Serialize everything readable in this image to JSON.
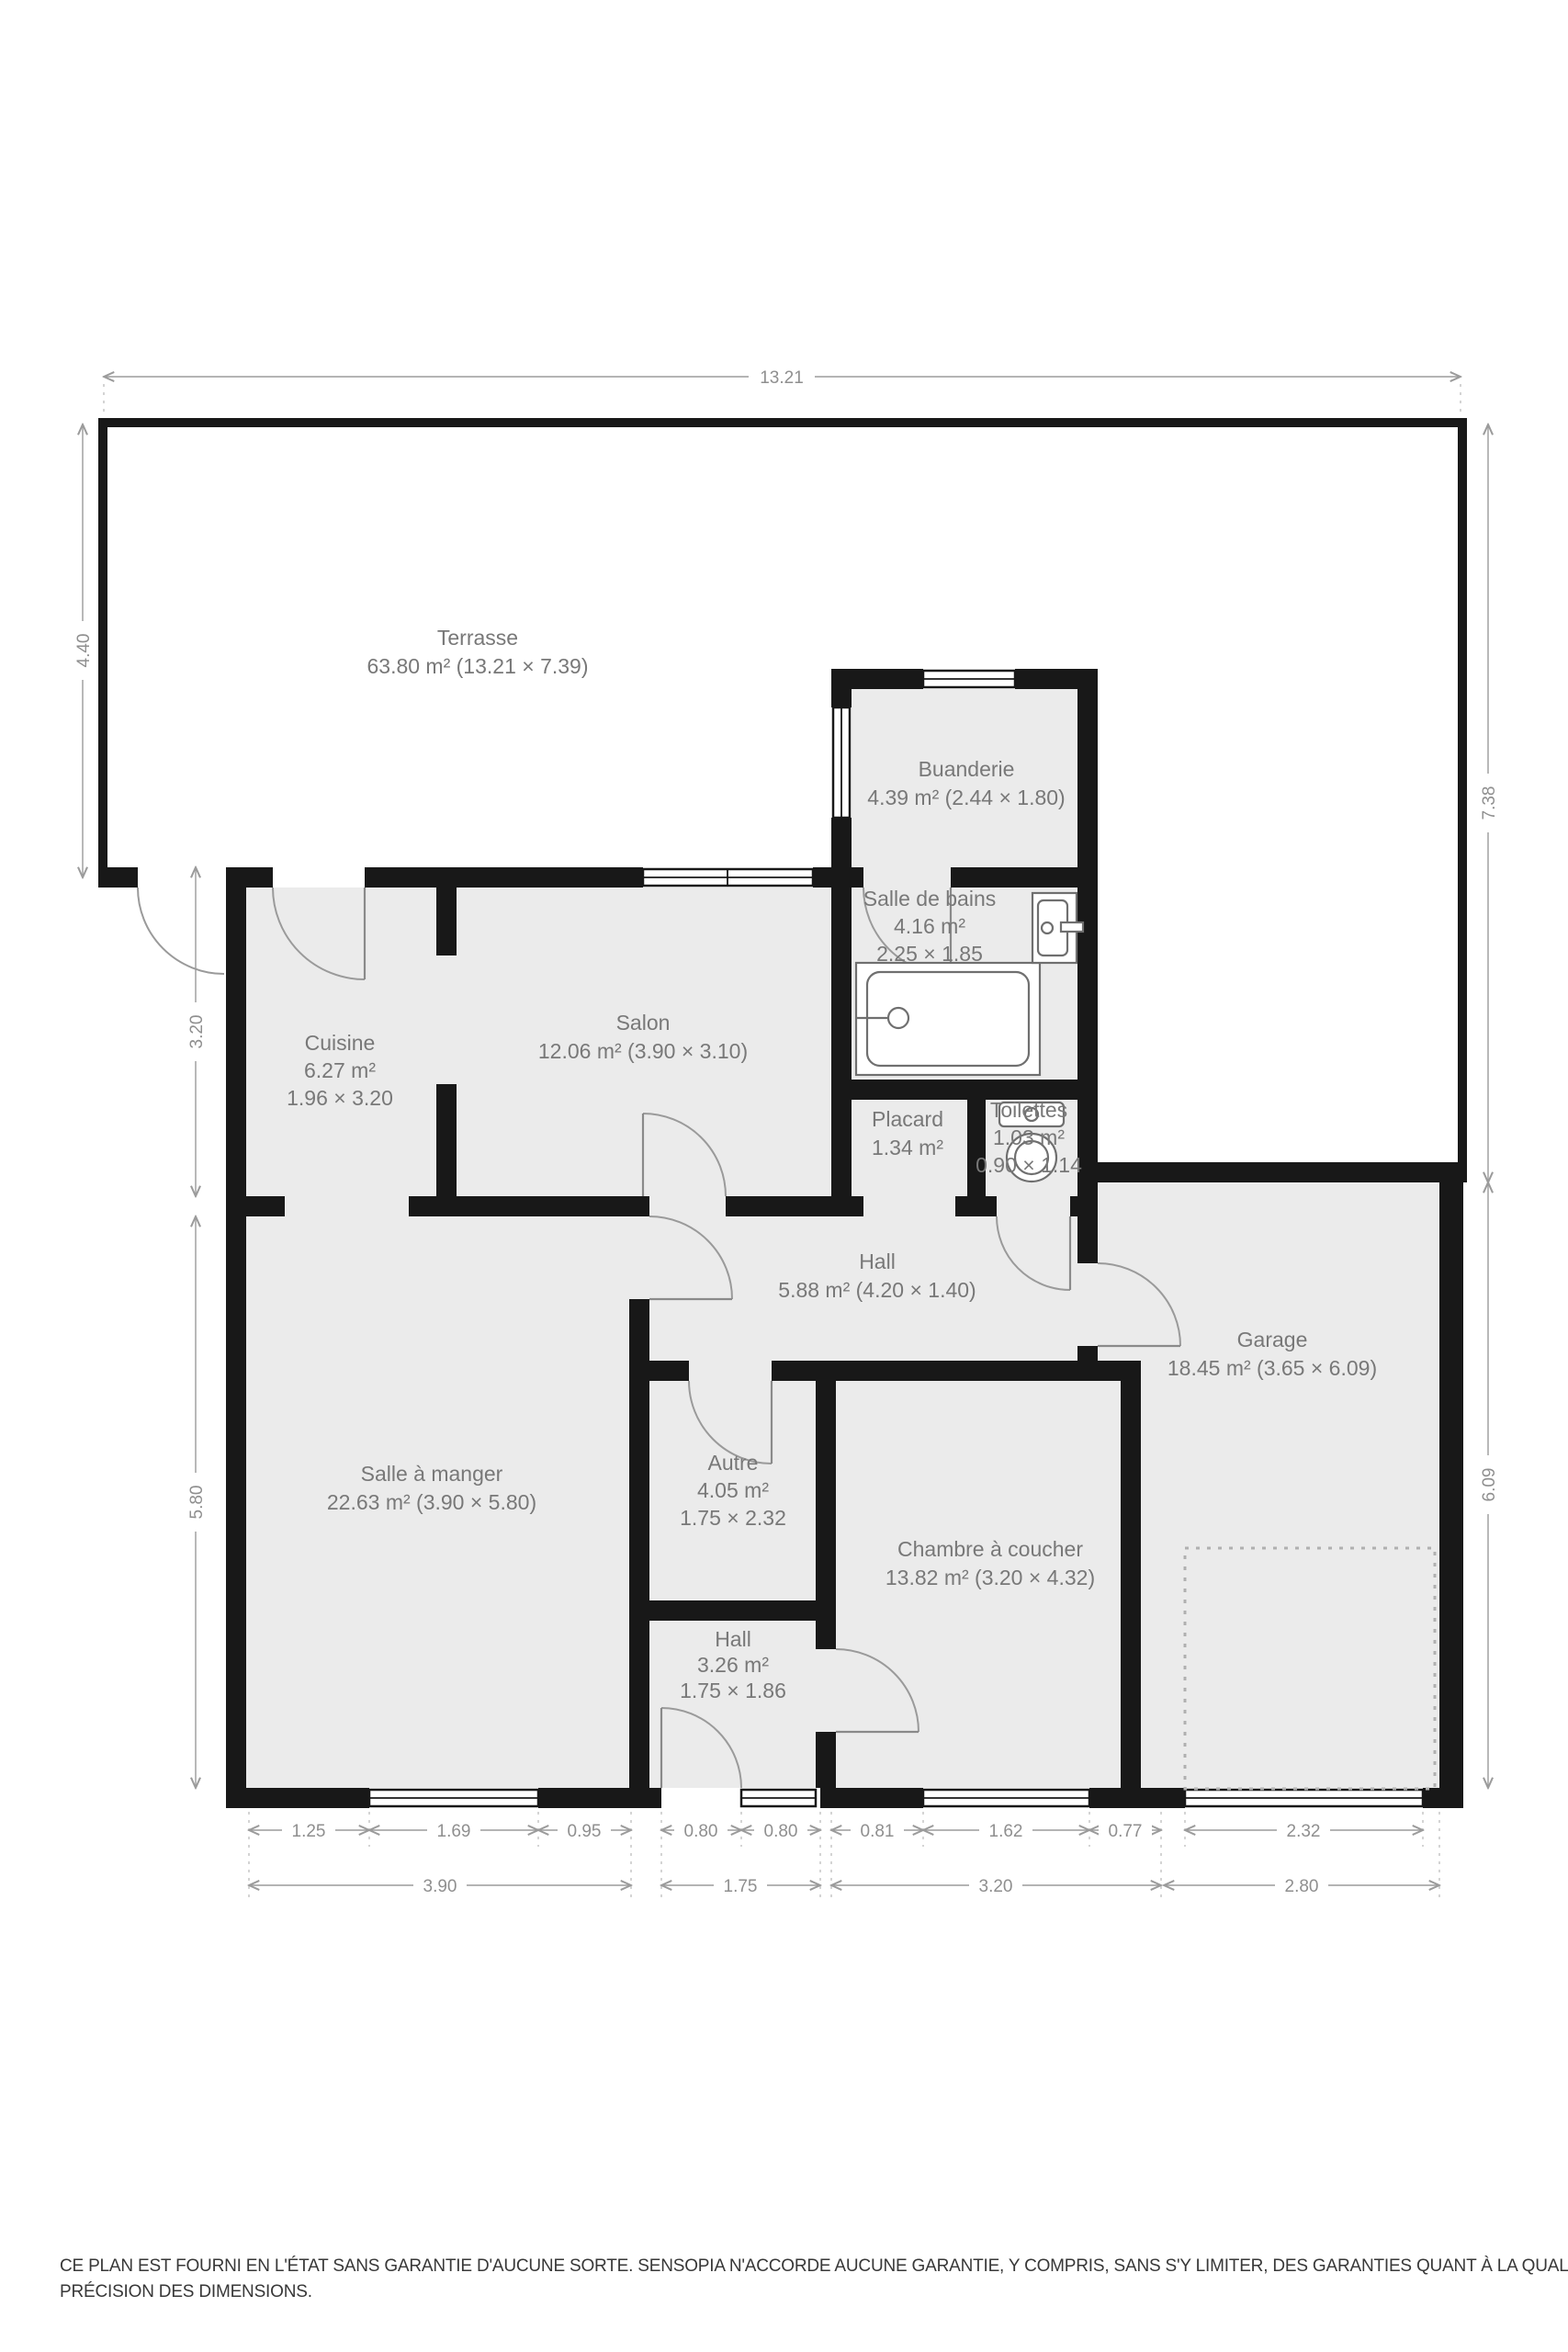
{
  "plan": {
    "rooms": {
      "terrasse": {
        "name": "Terrasse",
        "line2": "63.80 m² (13.21 × 7.39)"
      },
      "buanderie": {
        "name": "Buanderie",
        "line2": "4.39 m² (2.44 × 1.80)"
      },
      "salle_de_bains": {
        "name": "Salle de bains",
        "line2": "4.16 m²",
        "line3": "2.25 × 1.85"
      },
      "cuisine": {
        "name": "Cuisine",
        "line2": "6.27 m²",
        "line3": "1.96 × 3.20"
      },
      "salon": {
        "name": "Salon",
        "line2": "12.06 m² (3.90 × 3.10)"
      },
      "placard": {
        "name": "Placard",
        "line2": "1.34 m²"
      },
      "toilettes": {
        "name": "Toilettes",
        "line2": "1.03 m²",
        "line3": "0.90 × 1.14"
      },
      "hall": {
        "name": "Hall",
        "line2": "5.88 m² (4.20 × 1.40)"
      },
      "garage": {
        "name": "Garage",
        "line2": "18.45 m² (3.65 × 6.09)"
      },
      "salle_a_manger": {
        "name": "Salle à manger",
        "line2": "22.63 m² (3.90 × 5.80)"
      },
      "autre": {
        "name": "Autre",
        "line2": "4.05 m²",
        "line3": "1.75 × 2.32"
      },
      "chambre": {
        "name": "Chambre à coucher",
        "line2": "13.82 m² (3.20 × 4.32)"
      },
      "hall2": {
        "name": "Hall",
        "line2": "3.26 m²",
        "line3": "1.75 × 1.86"
      }
    },
    "dimensions": {
      "top": "13.21",
      "left_terrace": "4.40",
      "left_upper": "3.20",
      "left_lower": "5.80",
      "right_upper": "7.38",
      "right_lower": "6.09",
      "bottom_row1": [
        "1.25",
        "1.69",
        "0.95",
        "0.80",
        "0.80",
        "0.81",
        "1.62",
        "0.77",
        "2.32"
      ],
      "bottom_row2": [
        "3.90",
        "1.75",
        "3.20",
        "2.80"
      ]
    },
    "disclaimer_line1": "CE PLAN EST FOURNI EN L'ÉTAT SANS GARANTIE D'AUCUNE SORTE. SENSOPIA N'ACCORDE AUCUNE GARANTIE, Y COMPRIS, SANS S'Y LIMITER, DES GARANTIES QUANT À LA QUALITÉ ET À LA",
    "disclaimer_line2": "PRÉCISION DES DIMENSIONS.",
    "colors": {
      "wall": "#181818",
      "floor": "#ebebeb",
      "label": "#787878",
      "dimension": "#8f8f8f"
    }
  }
}
